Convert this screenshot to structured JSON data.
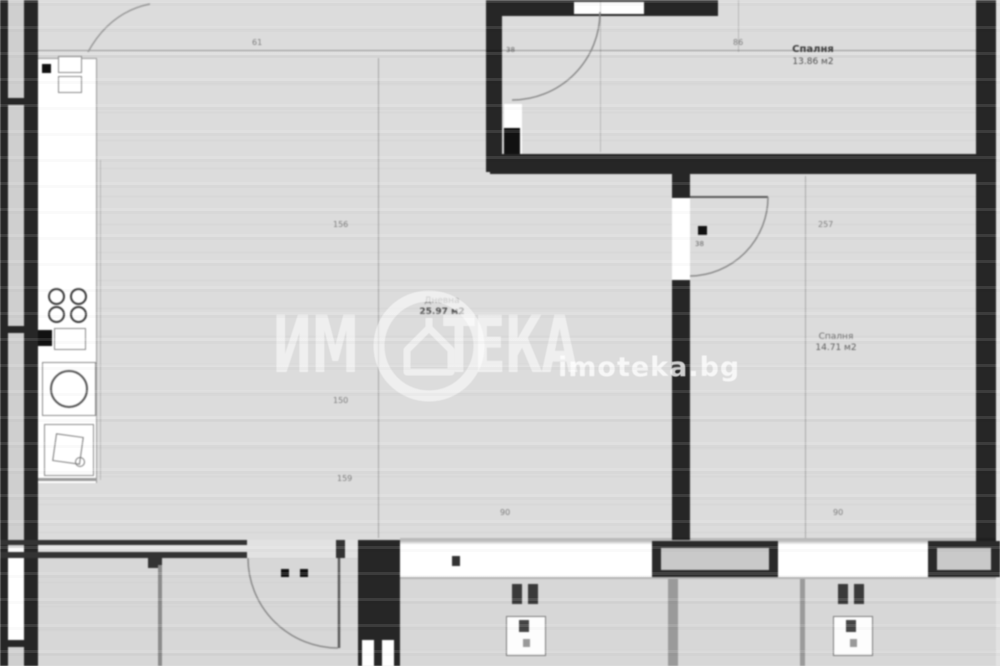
{
  "watermark": {
    "brand_prefix": "ИМ",
    "brand_suffix": "ТЕКА",
    "logo_icon": "house-in-circle",
    "website": "imoteka.bg"
  },
  "rooms": [
    {
      "name": "Спалня",
      "area": "13.86 м2"
    },
    {
      "name": "Дневна",
      "area": "25.97 м2"
    },
    {
      "name": "Спалня",
      "area": "14.71 м2"
    }
  ],
  "dimensions": {
    "top_left": "61",
    "top_right": "86",
    "left_chain": [
      "156",
      "150",
      "159"
    ],
    "right_chain": "257",
    "window_left": "90",
    "window_right": "90",
    "door_tag_top": "38",
    "door_tag_right": "38"
  },
  "colors": {
    "wall": "#262626",
    "floor": "#dcdcdc",
    "paper": "#e6e6e6",
    "fixture": "#ffffff",
    "watermark": "rgba(255,255,255,0.55)"
  }
}
